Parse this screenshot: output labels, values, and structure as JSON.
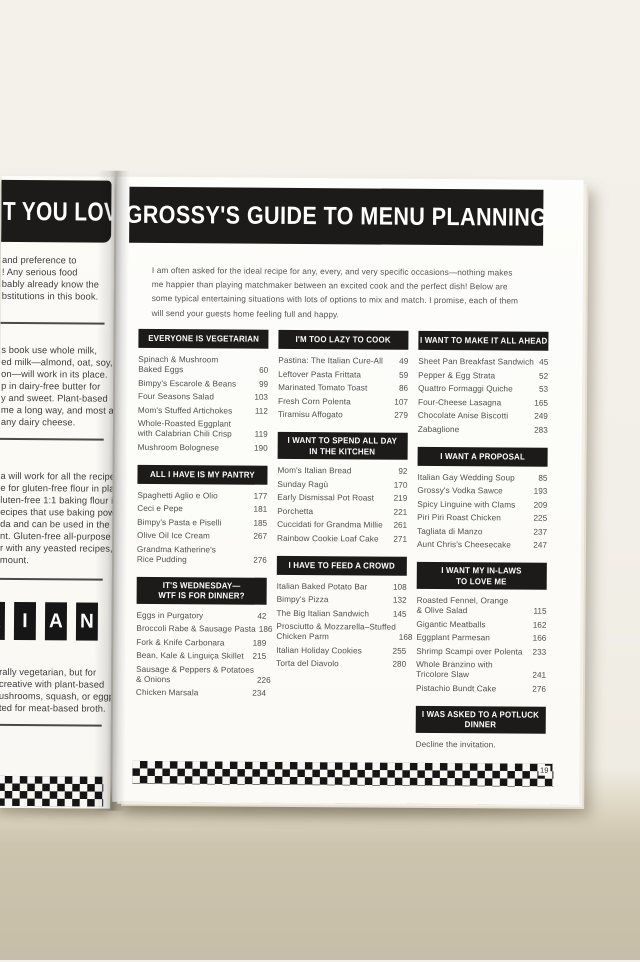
{
  "left_page": {
    "banner_fragment": "T YOU LOVE",
    "text_blocks": [
      {
        "lines": [
          "and preference to",
          "! Any serious food",
          "bably already know the",
          "bstitutions in this book."
        ]
      },
      {
        "lines": [
          "s book use whole milk,",
          "ed milk—almond, oat, soy,",
          "on—will work in its place.",
          "p in dairy-free butter for",
          "y and sweet. Plant-based",
          "me a long way, and most are",
          "any dairy cheese."
        ]
      },
      {
        "lines": [
          "a will work for all the recipes",
          "e for gluten-free flour in place",
          "luten-free 1:1 baking flour is",
          "ecipes that use baking powder",
          "da and can be used in the",
          "nt. Gluten-free all-purpose",
          "r with any yeasted recipes,",
          "mount."
        ]
      },
      {
        "lines": [
          "rally vegetarian, but for",
          "creative with plant-based",
          "ushrooms, squash, or eggplant,",
          "ted for meat-based broth."
        ]
      }
    ],
    "letter_tiles": [
      "R",
      "I",
      "A",
      "N"
    ]
  },
  "right_page": {
    "title": "GROSSY'S GUIDE TO MENU PLANNING",
    "intro": "I am often asked for the ideal recipe for any, every, and very specific occasions—nothing makes me happier than playing matchmaker between an excited cook and the perfect dish! Below are some typical entertaining situations with lots of options to mix and match. I promise, each of them will send your guests home feeling full and happy.",
    "page_number": "19",
    "columns": [
      {
        "sections": [
          {
            "header": "EVERYONE IS VEGETARIAN",
            "items": [
              {
                "name": "Spinach & Mushroom\nBaked Eggs",
                "page": "60"
              },
              {
                "name": "Bimpy's Escarole & Beans",
                "page": "99"
              },
              {
                "name": "Four Seasons Salad",
                "page": "103"
              },
              {
                "name": "Mom's Stuffed Artichokes",
                "page": "112"
              },
              {
                "name": "Whole-Roasted Eggplant\nwith Calabrian Chili Crisp",
                "page": "119"
              },
              {
                "name": "Mushroom Bolognese",
                "page": "190"
              }
            ]
          },
          {
            "header": "ALL I HAVE IS MY PANTRY",
            "items": [
              {
                "name": "Spaghetti Aglio e Olio",
                "page": "177"
              },
              {
                "name": "Ceci e Pepe",
                "page": "181"
              },
              {
                "name": "Bimpy's Pasta e Piselli",
                "page": "185"
              },
              {
                "name": "Olive Oil Ice Cream",
                "page": "267"
              },
              {
                "name": "Grandma Katherine's\nRice Pudding",
                "page": "276"
              }
            ]
          },
          {
            "header": "IT'S WEDNESDAY—\nWTF IS FOR DINNER?",
            "items": [
              {
                "name": "Eggs in Purgatory",
                "page": "42"
              },
              {
                "name": "Broccoli Rabe & Sausage Pasta",
                "page": "186"
              },
              {
                "name": "Fork & Knife Carbonara",
                "page": "189"
              },
              {
                "name": "Bean, Kale & Linguiça Skillet",
                "page": "215"
              },
              {
                "name": "Sausage & Peppers & Potatoes\n& Onions",
                "page": "226"
              },
              {
                "name": "Chicken Marsala",
                "page": "234"
              }
            ]
          }
        ]
      },
      {
        "sections": [
          {
            "header": "I'M TOO LAZY TO COOK",
            "items": [
              {
                "name": "Pastina: The Italian Cure-All",
                "page": "49"
              },
              {
                "name": "Leftover Pasta Frittata",
                "page": "59"
              },
              {
                "name": "Marinated Tomato Toast",
                "page": "86"
              },
              {
                "name": "Fresh Corn Polenta",
                "page": "107"
              },
              {
                "name": "Tiramisu Affogato",
                "page": "279"
              }
            ]
          },
          {
            "header": "I WANT TO SPEND ALL DAY\nIN THE KITCHEN",
            "items": [
              {
                "name": "Mom's Italian Bread",
                "page": "92"
              },
              {
                "name": "Sunday Ragù",
                "page": "170"
              },
              {
                "name": "Early Dismissal Pot Roast",
                "page": "219"
              },
              {
                "name": "Porchetta",
                "page": "221"
              },
              {
                "name": "Cuccidati for Grandma Millie",
                "page": "261"
              },
              {
                "name": "Rainbow Cookie Loaf Cake",
                "page": "271"
              }
            ]
          },
          {
            "header": "I HAVE TO FEED A CROWD",
            "items": [
              {
                "name": "Italian Baked Potato Bar",
                "page": "108"
              },
              {
                "name": "Bimpy's Pizza",
                "page": "132"
              },
              {
                "name": "The Big Italian Sandwich",
                "page": "145"
              },
              {
                "name": "Prosciutto & Mozzarella–Stuffed\nChicken Parm",
                "page": "168"
              },
              {
                "name": "Italian Holiday Cookies",
                "page": "255"
              },
              {
                "name": "Torta del Diavolo",
                "page": "280"
              }
            ]
          }
        ]
      },
      {
        "sections": [
          {
            "header": "I WANT TO MAKE IT ALL AHEAD",
            "items": [
              {
                "name": "Sheet Pan Breakfast Sandwich",
                "page": "45"
              },
              {
                "name": "Pepper & Egg Strata",
                "page": "52"
              },
              {
                "name": "Quattro Formaggi Quiche",
                "page": "53"
              },
              {
                "name": "Four-Cheese Lasagna",
                "page": "165"
              },
              {
                "name": "Chocolate Anise Biscotti",
                "page": "249"
              },
              {
                "name": "Zabaglione",
                "page": "283"
              }
            ]
          },
          {
            "header": "I WANT A PROPOSAL",
            "items": [
              {
                "name": "Italian Gay Wedding Soup",
                "page": "85"
              },
              {
                "name": "Grossy's Vodka Sawce",
                "page": "193"
              },
              {
                "name": "Spicy Linguine with Clams",
                "page": "209"
              },
              {
                "name": "Piri Piri Roast Chicken",
                "page": "225"
              },
              {
                "name": "Tagliata di Manzo",
                "page": "237"
              },
              {
                "name": "Aunt Chris's Cheesecake",
                "page": "247"
              }
            ]
          },
          {
            "header": "I WANT MY IN-LAWS\nTO LOVE ME",
            "items": [
              {
                "name": "Roasted Fennel, Orange\n& Olive Salad",
                "page": "115"
              },
              {
                "name": "Gigantic Meatballs",
                "page": "162"
              },
              {
                "name": "Eggplant Parmesan",
                "page": "166"
              },
              {
                "name": "Shrimp Scampi over Polenta",
                "page": "233"
              },
              {
                "name": "Whole Branzino with\nTricolore Slaw",
                "page": "241"
              },
              {
                "name": "Pistachio Bundt Cake",
                "page": "276"
              }
            ]
          },
          {
            "header": "I WAS ASKED TO A POTLUCK\nDINNER",
            "items": [],
            "note": "Decline the invitation."
          }
        ]
      }
    ]
  },
  "colors": {
    "banner_black": "#1c1b19",
    "page_white": "#fcfbf8",
    "backdrop_cream": "#f3f0ea",
    "surface_tan": "#c9c1aa",
    "body_text": "#4f4f4f"
  }
}
